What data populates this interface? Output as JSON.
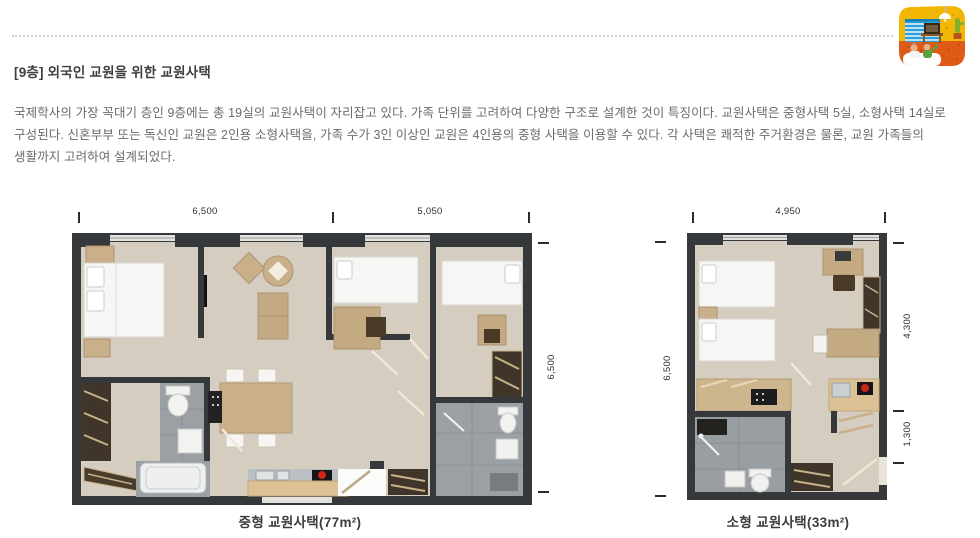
{
  "header": {
    "icon": "room-interior-illustration",
    "divider_style": "dotted"
  },
  "article": {
    "title": "[9층] 외국인 교원을 위한 교원사택",
    "body_lines": [
      "국제학사의 가장 꼭대기 층인 9층에는 총 19실의 교원사택이 자리잡고 있다. 가족 단위를 고려하여 다양한 구조로 설계한 것이 특징이다. 교원사택은 중형사택 5실, 소형사택 14실로",
      "구성된다. 신혼부부 또는 독신인 교원은 2인용 소형사택을, 가족 수가 3인 이상인 교원은 4인용의 중형 사택을 이용할 수 있다. 각 사택은 쾌적한 주거환경은 물론, 교원 가족들의",
      "생활까지 고려하여 설계되었다."
    ]
  },
  "floorplans": [
    {
      "name": "medium-faculty-residence",
      "caption": "중형 교원사택(77m²)",
      "dimensions": {
        "top": [
          "6,500",
          "5,050"
        ],
        "right": [
          "6,500"
        ]
      }
    },
    {
      "name": "small-faculty-residence",
      "caption": "소형 교원사택(33m²)",
      "dimensions": {
        "top": [
          "4,950"
        ],
        "left": [
          "6,500"
        ],
        "right": [
          "4,300",
          "1,300"
        ]
      }
    }
  ],
  "colors": {
    "wall": "#36393c",
    "floor": "#d5cdbf",
    "bath_floor": "#9ba0a4",
    "wood_light": "#c9b08a",
    "wood_dark": "#3f3528",
    "counter": "#dcc195",
    "stove_red": "#cc2615",
    "icon_yellow": "#f2b705",
    "icon_orange": "#e05a17",
    "icon_blue": "#2e9fd9",
    "icon_green": "#59a33f",
    "dotted_line": "#cfcfcf",
    "title_text": "#3f3f3f",
    "body_text": "#6b6b6b"
  }
}
